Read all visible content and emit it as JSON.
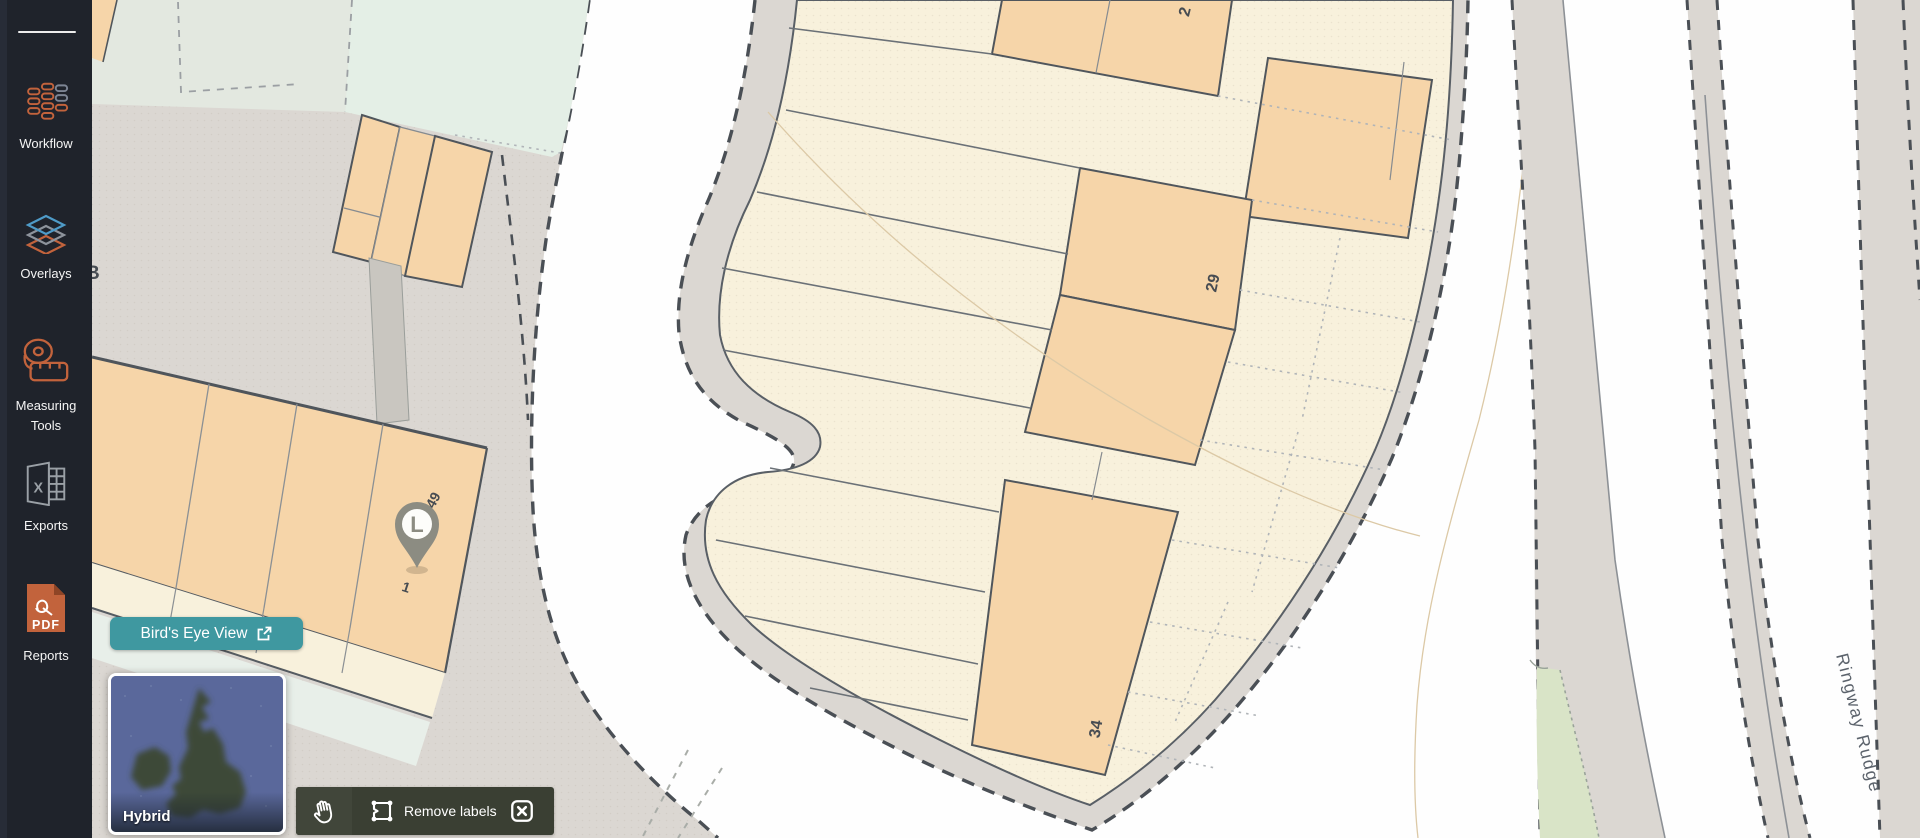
{
  "sidebar": {
    "items": [
      {
        "label": "Workflow"
      },
      {
        "label": "Overlays"
      },
      {
        "label": "Measuring Tools"
      },
      {
        "label": "Exports"
      },
      {
        "label": "Reports"
      }
    ]
  },
  "map": {
    "labels": {
      "partial_building": "B",
      "plot_top_partial": "2",
      "plot_29": "29",
      "plot_34": "34",
      "plot_49": "49",
      "plot_1": "1",
      "pin_letter": "L",
      "street_name": "Ringway Rudge"
    }
  },
  "overlays": {
    "birds_eye_button": {
      "label": "Bird's Eye View"
    },
    "basemap_toggle": {
      "label": "Hybrid"
    },
    "map_toolbar": {
      "remove_labels_label": "Remove labels"
    }
  },
  "colors": {
    "accent_orange": "#c2633c",
    "teal_button": "#3f98a0",
    "sidebar_bg": "#1f232b",
    "parcel_orange": "#f6d5a9",
    "parcel_cream": "#f8f1dc",
    "map_gray": "#dbd7d2",
    "toolbar_bg": "#3a3f33"
  }
}
